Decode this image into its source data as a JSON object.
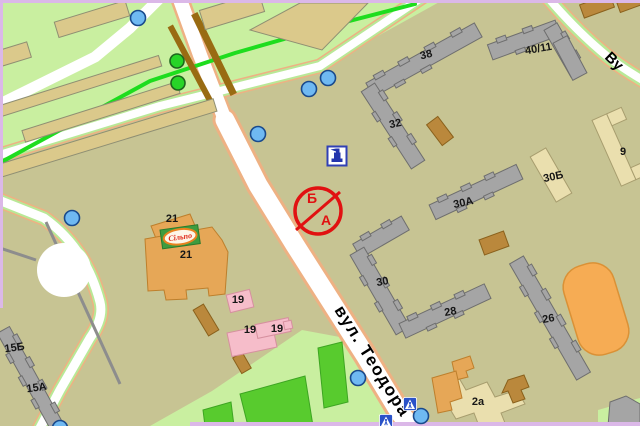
{
  "streets": {
    "main": "вул. Теодора",
    "top_right": "Ву"
  },
  "restriction_sign": {
    "top_letter": "Б",
    "bottom_letter": "А"
  },
  "logo": {
    "text": "Сільпо"
  },
  "buildings": {
    "b38": "38",
    "b32": "32",
    "b40_11": "40/11",
    "b30a": "30А",
    "b30b": "30Б",
    "b9": "9",
    "b30": "30",
    "b28": "28",
    "b26": "26",
    "b15b": "15Б",
    "b15a": "15А",
    "b21_top": "21",
    "b21_main": "21",
    "b19_top": "19",
    "b19_mid": "19",
    "b19_right": "19",
    "b2a": "2а"
  },
  "colors": {
    "park_green": "#c9efa0",
    "block_khaki": "#c7c493",
    "sports_field": "#58cb2e",
    "road_white": "#ffffff",
    "road_verge": "#b9e897",
    "road_casing": "#eeb183",
    "boundary_violet": "#dbb8e8",
    "tram_line": "#1edd1e",
    "building_gray": "#a5a5a5",
    "building_tan": "#dbc98b",
    "building_beige": "#eadfae",
    "building_orange": "#e6a757",
    "building_pink": "#f6bdca",
    "building_brown": "#ba883c",
    "stadium_orange": "#f6ac54",
    "marker_blue": "#6fb9f2",
    "marker_green": "#27d427",
    "sign_red": "#e11111",
    "poi_icon_blue": "#2335ad"
  }
}
